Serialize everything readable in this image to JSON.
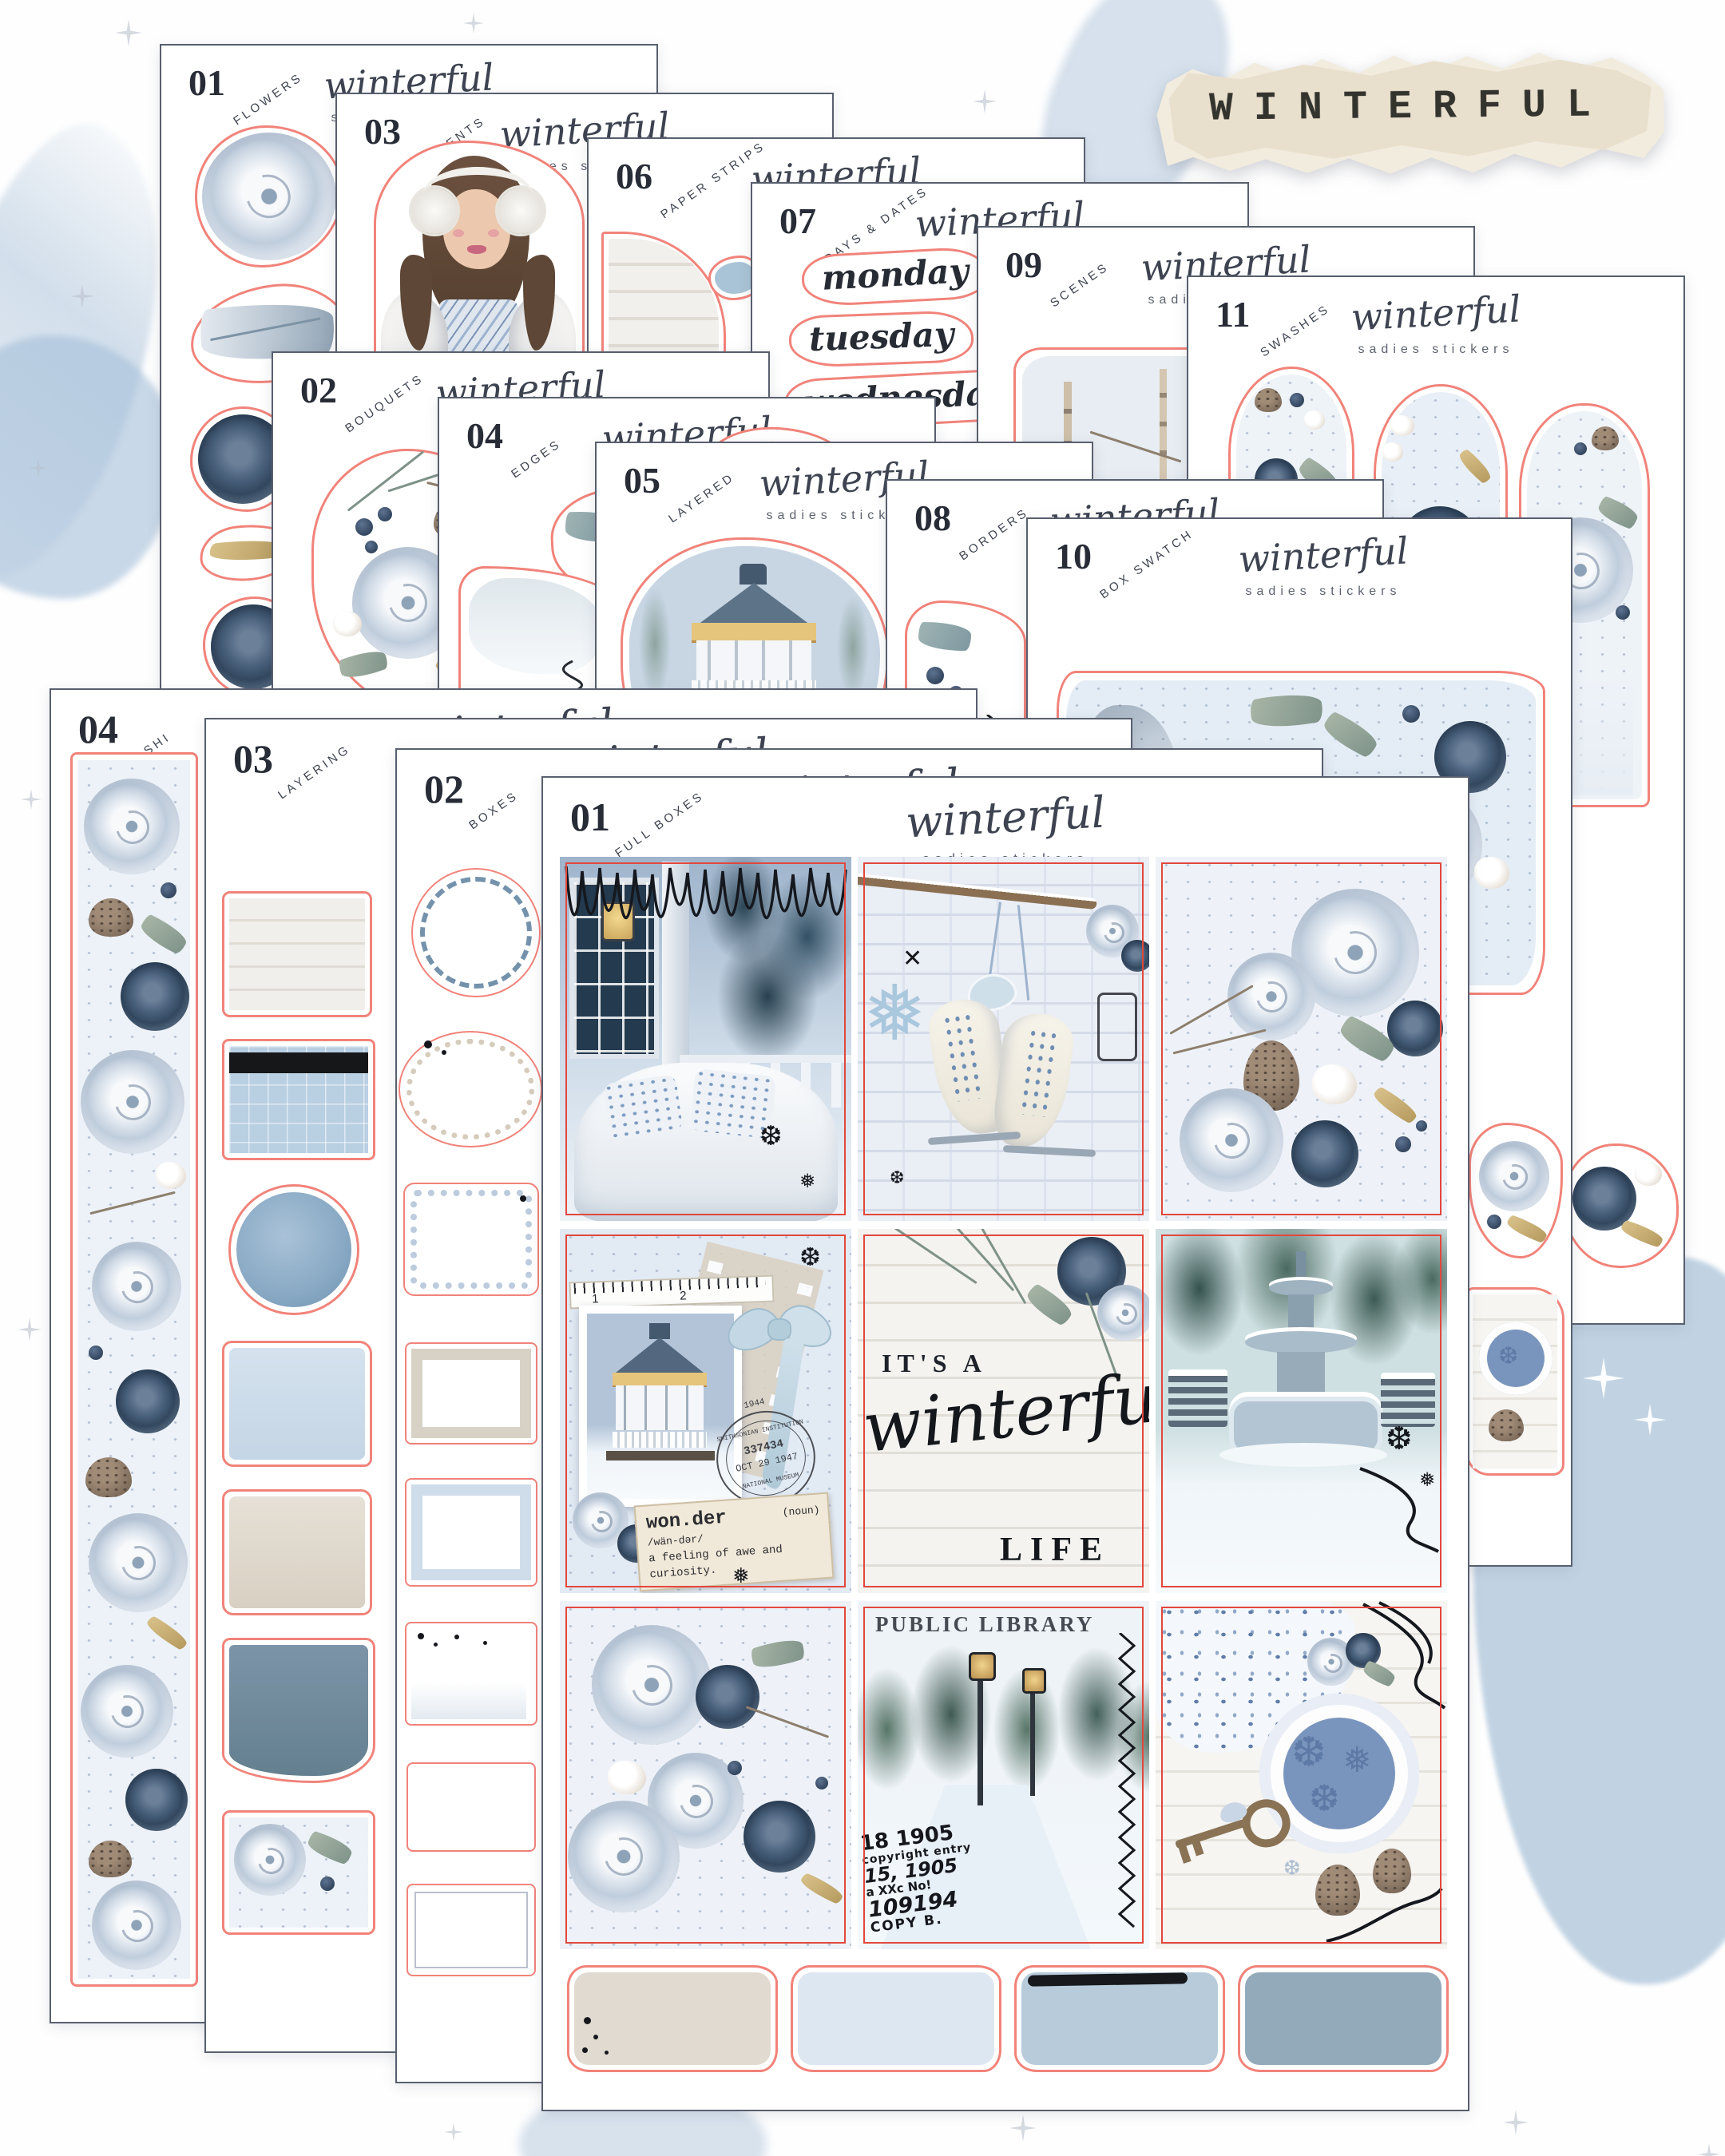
{
  "banner": {
    "title": "WINTERFUL"
  },
  "brand": {
    "script": "winterful",
    "sub": "sadies stickers"
  },
  "back_sheets": [
    {
      "num": "01",
      "label": "FLOWERS"
    },
    {
      "num": "03",
      "label": "ELEMENTS"
    },
    {
      "num": "06",
      "label": "PAPER STRIPS"
    },
    {
      "num": "07",
      "label": "DAYS & DATES"
    },
    {
      "num": "09",
      "label": "SCENES"
    },
    {
      "num": "11",
      "label": "SWASHES"
    },
    {
      "num": "02",
      "label": "BOUQUETS"
    },
    {
      "num": "04",
      "label": "EDGES"
    },
    {
      "num": "05",
      "label": "LAYERED"
    },
    {
      "num": "08",
      "label": "BORDERS"
    },
    {
      "num": "10",
      "label": "BOX SWATCH"
    }
  ],
  "front_sheets": [
    {
      "num": "04",
      "label": "WASHI"
    },
    {
      "num": "03",
      "label": "LAYERING"
    },
    {
      "num": "02",
      "label": "BOXES"
    },
    {
      "num": "01",
      "label": "FULL BOXES"
    }
  ],
  "days": [
    "monday",
    "tuesday",
    "wednesday"
  ],
  "quote": {
    "line1": "IT'S A",
    "line2": "winterful",
    "line3": "LIFE"
  },
  "library_box": {
    "title": "PUBLIC LIBRARY",
    "stamp_lines": [
      "18 1905",
      "copyright entry",
      "15, 1905",
      "a XXc No!",
      "109194",
      "COPY B."
    ]
  },
  "wonder_tag": {
    "word": "won.der",
    "pos": "(noun)",
    "phonetic": "/wän-dər/",
    "def_line1": "a feeling of awe and",
    "def_line2": "curiosity."
  },
  "postmark": {
    "year": "1944",
    "arc_top": "SMITHSONIAN INSTITUTION",
    "number": "337434",
    "date": "OCT 29 1947",
    "arc_bottom": "NATIONAL MUSEUM"
  },
  "gazebo_box": {
    "ruler_marks": [
      "1",
      "2"
    ]
  },
  "palette": {
    "cut_line": "#F1837A",
    "box_line": "#E2473D",
    "sheet_border": "#585F6E",
    "ink": "#272C37",
    "script_ink": "#3D4350",
    "banner_paper": "#EFE8D9",
    "wash_blue": "#B0C6DB",
    "navy_rose": "#3C5068",
    "swatch_greige": "#E0DAD0",
    "swatch_pale_blue": "#DDE7F1",
    "swatch_powder_blue": "#B7CBDB",
    "swatch_slate_blue": "#93AABA"
  }
}
